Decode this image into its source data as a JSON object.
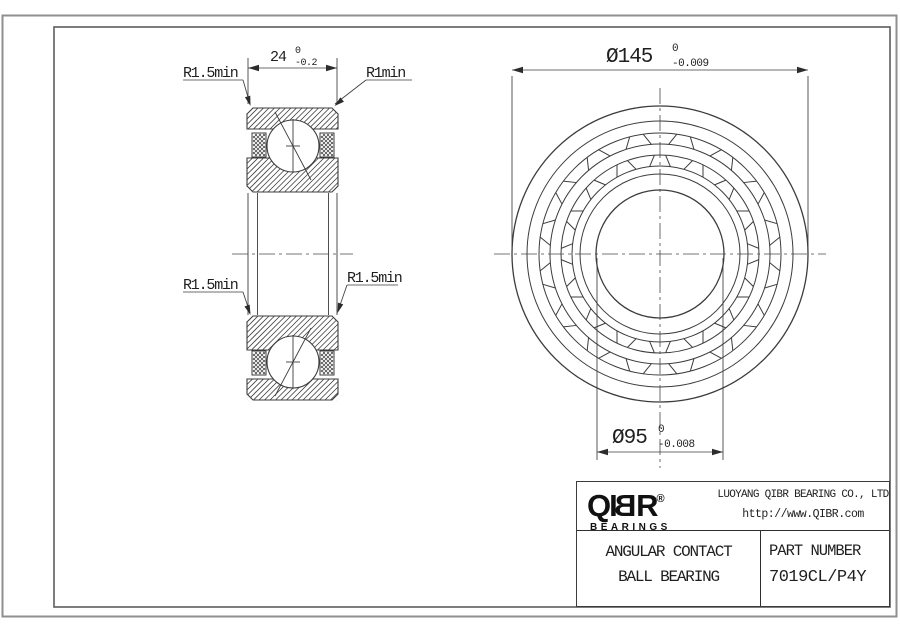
{
  "sheet": {
    "background": "#ffffff",
    "frame_outer_color": "#8f8f8f",
    "frame_inner_color": "#5d5d5d",
    "line_color": "#3c3c3c",
    "text_color": "#1f1f1f"
  },
  "section_view": {
    "dim_width": {
      "value": "24",
      "tol_upper": "0",
      "tol_lower": "-0.2"
    },
    "label_top_left": "R1.5min",
    "label_top_right": "R1min",
    "label_mid_left": "R1.5min",
    "label_mid_right": "R1.5min"
  },
  "front_view": {
    "dim_outer_diameter": {
      "value": "Ø145",
      "tol_upper": "0",
      "tol_lower": "-0.009"
    },
    "dim_bore_diameter": {
      "value": "Ø95",
      "tol_upper": "0",
      "tol_lower": "-0.008"
    }
  },
  "title_block": {
    "logo": {
      "part1": "QI",
      "part2": "B",
      "part3": "R",
      "registered": "®",
      "subtext": "BEARINGS"
    },
    "company_name": "LUOYANG QIBR BEARING CO., LTD",
    "company_url": "http://www.QIBR.com",
    "product_line1": "ANGULAR CONTACT",
    "product_line2": "BALL BEARING",
    "part_number_label": "PART NUMBER",
    "part_number": "7019CL/P4Y"
  }
}
